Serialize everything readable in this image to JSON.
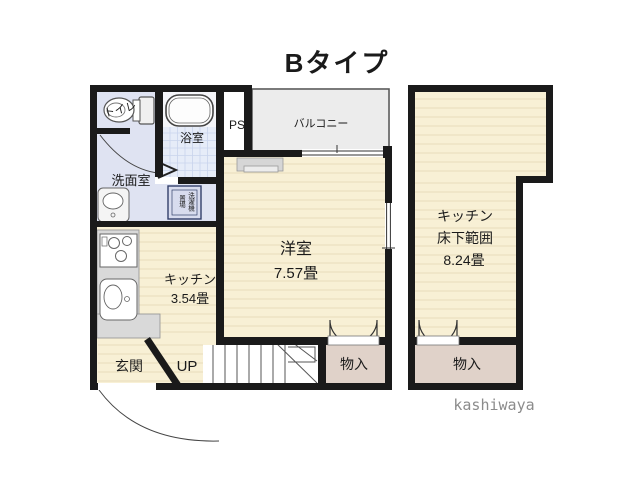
{
  "title": "Bタイプ",
  "credit": "kashiwaya",
  "colors": {
    "wall": "#1a1a1a",
    "wood_floor": "#f8f0d5",
    "plank_line": "#e8ddbc",
    "lavender_floor": "#dfe3f2",
    "washer_floor": "#d8dcee",
    "tile_floor": "#e6ecf8",
    "tile_line": "#c8d4ec",
    "balcony_floor": "#ececec",
    "closet_floor": "#e0d2c9",
    "counter_gray": "#d9d9d9",
    "credit_gray": "#8c8c8c"
  },
  "floor1": {
    "toilet": "トイレ",
    "bath": "浴室",
    "pipe_space": "PS",
    "balcony": "バルコニー",
    "washroom": "洗面室",
    "washer_right": "洗濯機",
    "washer_left": "置場",
    "kitchen": "キッチン",
    "kitchen_size": "3.54畳",
    "room": "洋室",
    "room_size": "7.57畳",
    "entrance": "玄関",
    "up": "UP",
    "closet": "物入"
  },
  "floor2": {
    "kitchen": "キッチン",
    "under_floor": "床下範囲",
    "size": "8.24畳",
    "closet": "物入"
  }
}
